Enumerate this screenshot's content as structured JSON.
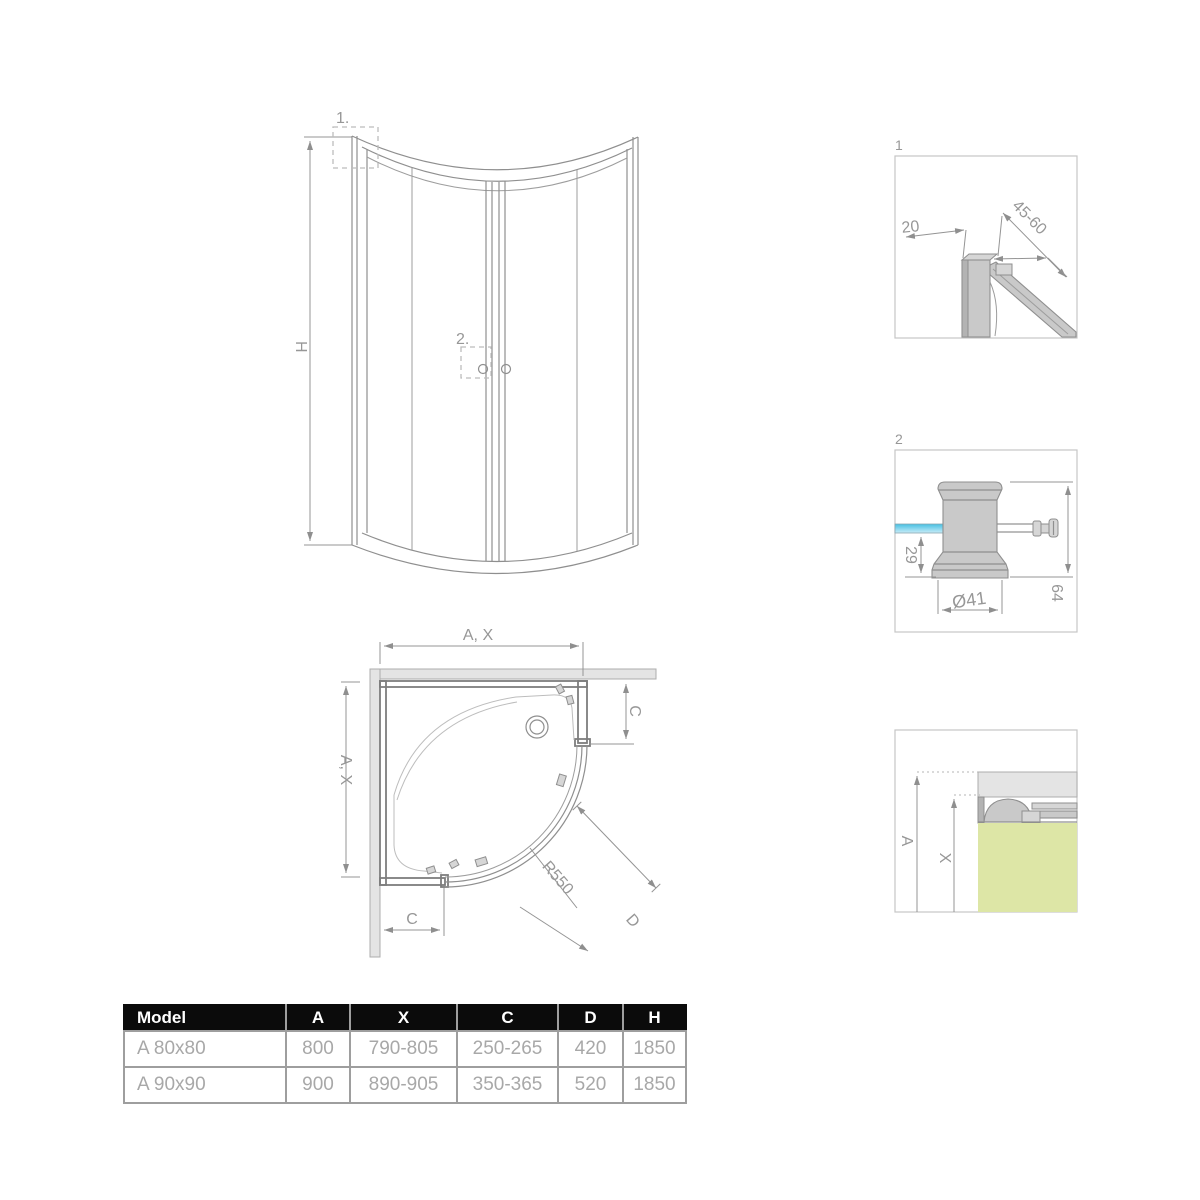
{
  "front_view": {
    "callout_1": "1.",
    "callout_2": "2.",
    "dim_height": "H"
  },
  "plan_view": {
    "dim_width_top": "A, X",
    "dim_width_left": "A, X",
    "dim_c_right": "C",
    "dim_c_bottom": "C",
    "dim_radius": "R550",
    "dim_d": "D"
  },
  "detail_1": {
    "label": "1",
    "dim_profile_depth": "20",
    "dim_adjust_range": "45-60"
  },
  "detail_2": {
    "label": "2",
    "dim_glass_offset": "29",
    "dim_knob_diameter": "Ø41",
    "dim_total_height": "64"
  },
  "detail_3": {
    "dim_a": "A",
    "dim_x": "X"
  },
  "table": {
    "headers": [
      "Model",
      "A",
      "X",
      "C",
      "D",
      "H"
    ],
    "rows": [
      [
        "A 80x80",
        "800",
        "790-805",
        "250-265",
        "420",
        "1850"
      ],
      [
        "A 90x90",
        "900",
        "890-905",
        "350-365",
        "520",
        "1850"
      ]
    ]
  },
  "colors": {
    "line_gray": "#8f8f8f",
    "wall_fill": "#e4e4e4",
    "profile_fill": "#c9c9c9",
    "glass_blue": "#45bfe2",
    "glass_blue_light": "#c9ecf7",
    "tray_green": "#dde6a6",
    "table_header_bg": "#0b0b0b",
    "table_text_gray": "#a8a8a8",
    "table_border": "#9e9e9e"
  }
}
